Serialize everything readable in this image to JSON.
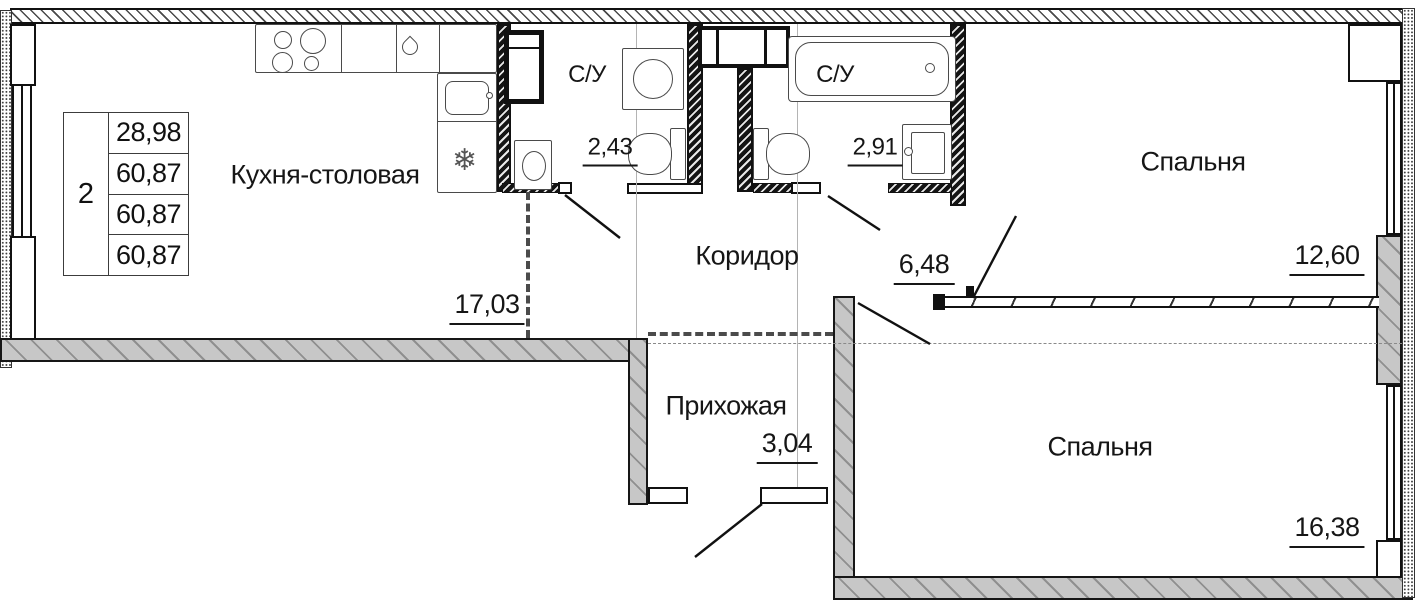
{
  "info_table": {
    "rooms_count": "2",
    "rows": [
      "28,98",
      "60,87",
      "60,87",
      "60,87"
    ]
  },
  "rooms": {
    "kitchen": {
      "name": "Кухня-столовая",
      "area": "17,03"
    },
    "bathroom_1": {
      "name": "С/У",
      "area": "2,43"
    },
    "bathroom_2": {
      "name": "С/У",
      "area": "2,91"
    },
    "corridor": {
      "name": "Коридор",
      "area": "6,48"
    },
    "bedroom_1": {
      "name": "Спальня",
      "area": "12,60"
    },
    "hallway": {
      "name": "Прихожая",
      "area": "3,04"
    },
    "bedroom_2": {
      "name": "Спальня",
      "area": "16,38"
    }
  },
  "icons": {
    "snowflake": "❄"
  },
  "colors": {
    "line": "#111111",
    "wall_fill": "#c7c7c7",
    "axis": "#b4b4b4"
  }
}
